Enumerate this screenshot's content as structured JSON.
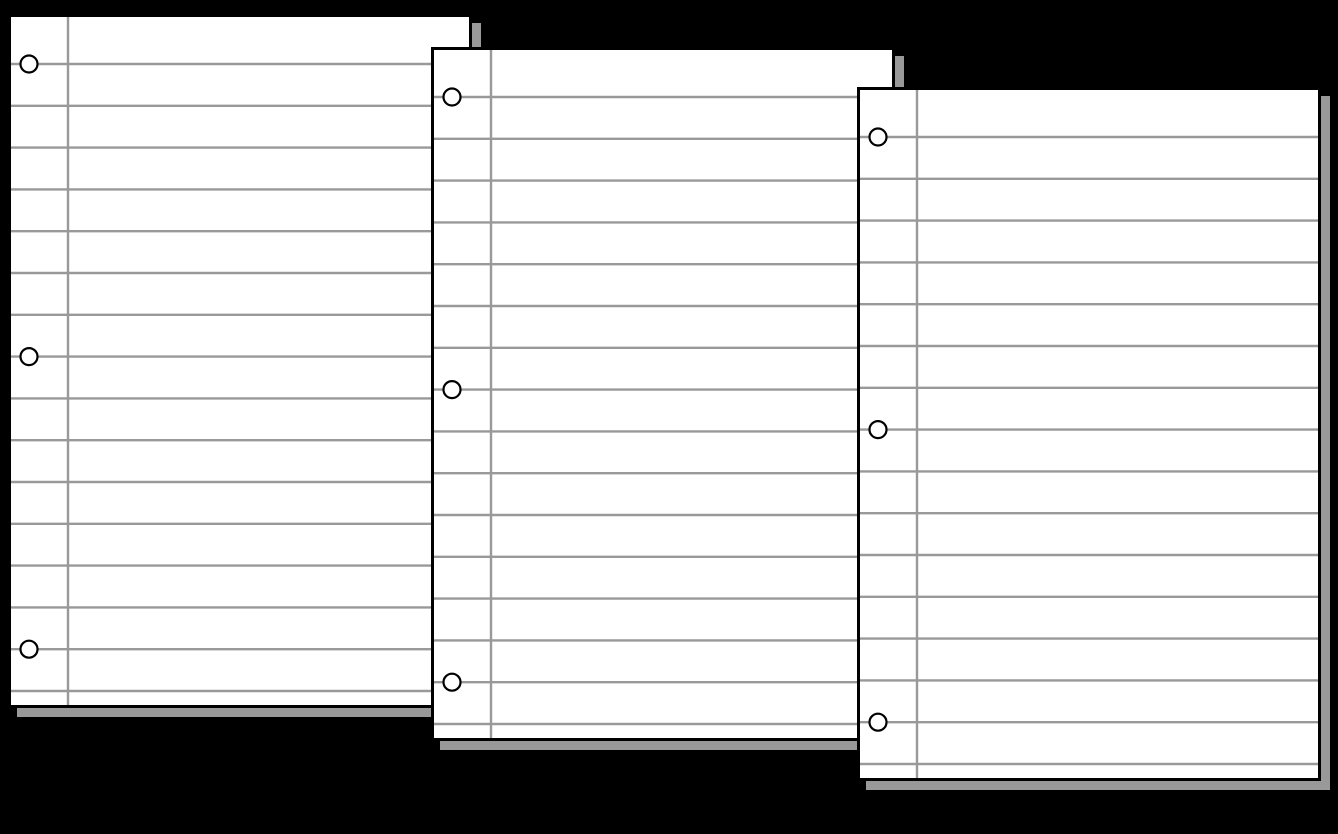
{
  "canvas": {
    "width": 1338,
    "height": 834,
    "background_color": "#000000"
  },
  "paper": {
    "width": 464,
    "height": 694,
    "fill_color": "#ffffff",
    "border_color": "#000000",
    "border_width": 3,
    "ruled_line_color": "#999999",
    "ruled_line_width": 2.4,
    "ruled_line_count": 16,
    "first_line_y": 50,
    "line_spacing": 41.8,
    "margin_line_x": 60,
    "margin_line_color": "#999999",
    "margin_line_width": 2.4,
    "hole": {
      "center_x": 21,
      "radius": 8.5,
      "stroke_color": "#000000",
      "stroke_width": 2.2,
      "fill_color": "#ffffff",
      "on_line_indices": [
        0,
        7,
        14
      ]
    },
    "shadow": {
      "color": "#999999",
      "offset_x": 9,
      "offset_y": 9
    }
  },
  "sheets": [
    {
      "name": "notebook-paper-1",
      "x": 8,
      "y": 14
    },
    {
      "name": "notebook-paper-2",
      "x": 431,
      "y": 47
    },
    {
      "name": "notebook-paper-3",
      "x": 857,
      "y": 87
    }
  ]
}
